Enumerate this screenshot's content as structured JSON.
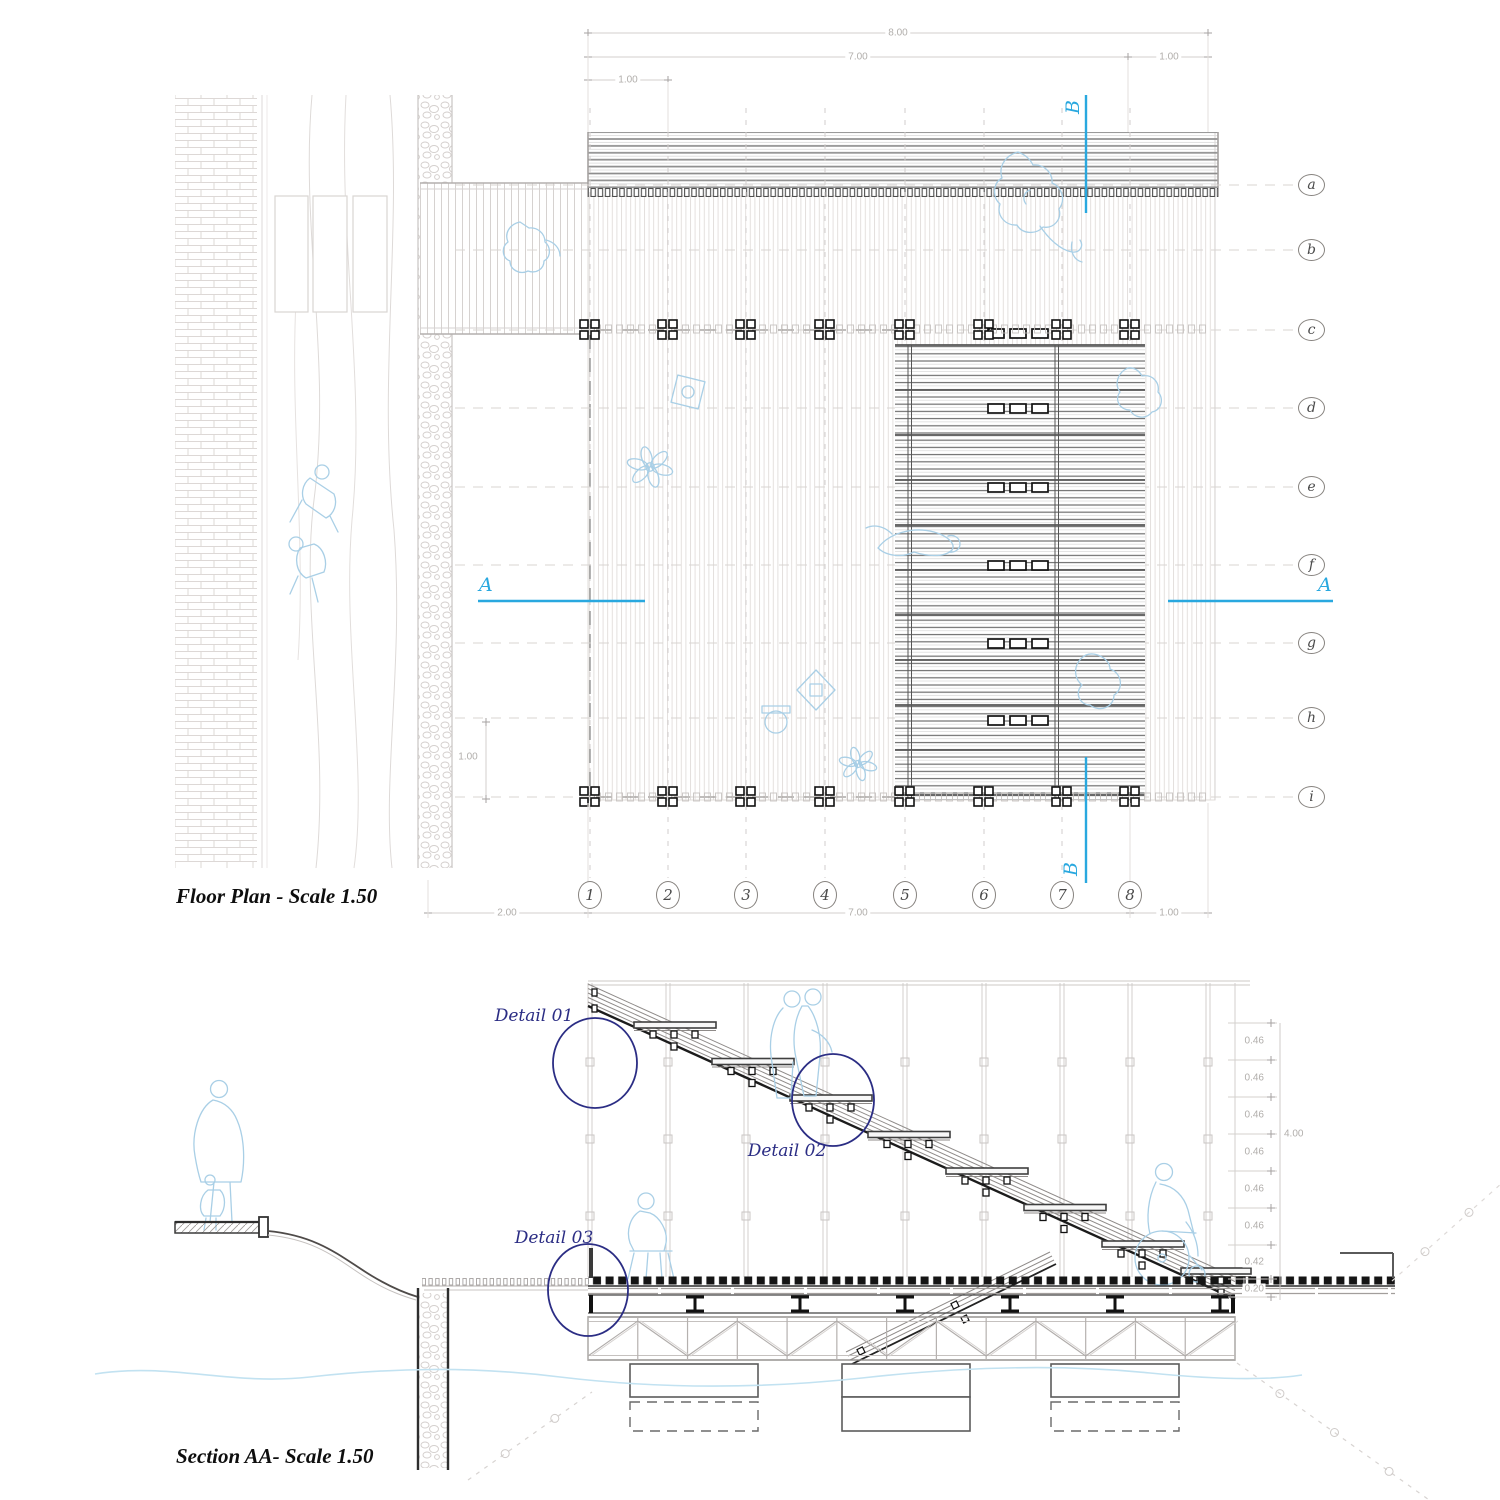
{
  "plan": {
    "title": "Floor Plan - Scale 1.50",
    "grid": {
      "rows": [
        "a",
        "b",
        "c",
        "d",
        "e",
        "f",
        "g",
        "h",
        "i"
      ],
      "cols": [
        "1",
        "2",
        "3",
        "4",
        "5",
        "6",
        "7",
        "8"
      ]
    },
    "dims": {
      "top_overall": "8.00",
      "top_span": "7.00",
      "top_right_bay": "1.00",
      "top_left_bay": "1.00",
      "bottom_left": "2.00",
      "bottom_span": "7.00",
      "bottom_right_bay": "1.00",
      "left_bay": "1.00"
    },
    "markers": {
      "a_left": "A",
      "a_right": "A",
      "b_top": "B",
      "b_bottom": "B"
    }
  },
  "section": {
    "title": "Section AA- Scale 1.50",
    "details": [
      "Detail 01",
      "Detail 02",
      "Detail 03"
    ],
    "dims": {
      "ladder": [
        "0.46",
        "0.46",
        "0.46",
        "0.46",
        "0.46",
        "0.46",
        "0.42",
        "0.20"
      ],
      "overall": "4.00"
    }
  },
  "colors": {
    "cyan": "#29a8df",
    "navy": "#2b2d84",
    "silhouette": "#a9cfe6",
    "water": "#c2e2f1",
    "dim_text": "#b1aeab",
    "line_dark": "#1c1c1c",
    "line_mid": "#8f8b89",
    "line_light": "#dcd8d6"
  }
}
